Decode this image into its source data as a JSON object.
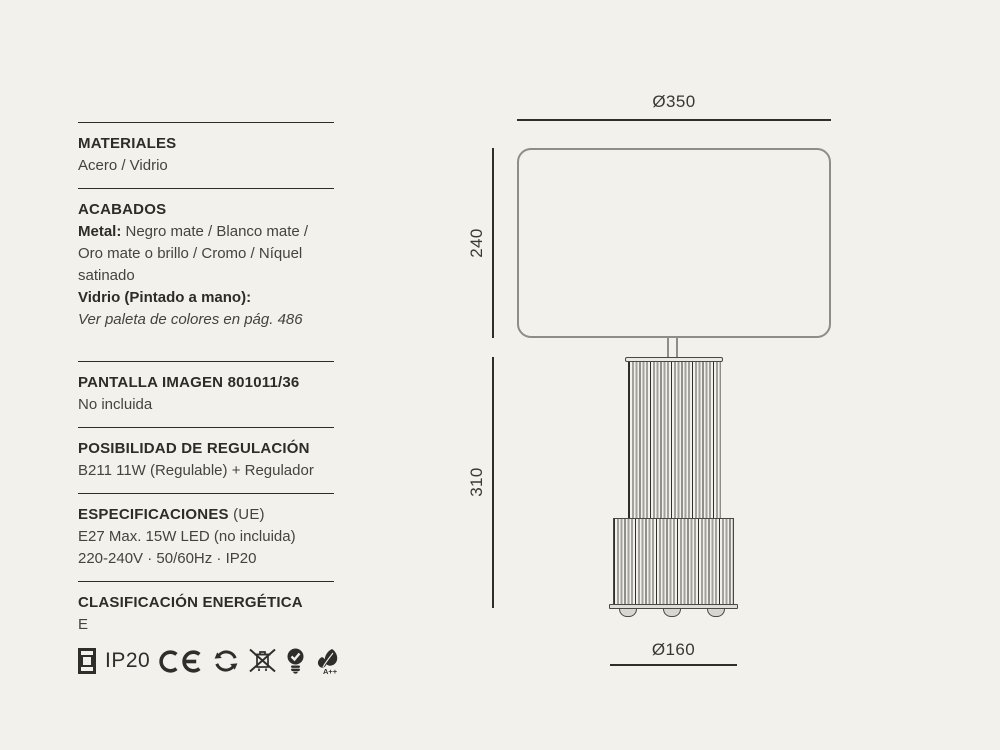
{
  "page": {
    "background_color": "#f2f1ec",
    "heading_color": "#2e2c27",
    "body_color": "#45433d",
    "drawing_line_color": "#8e8d87",
    "dimension_line_color": "#2f2e2a"
  },
  "specs": {
    "materiales": {
      "heading": "MATERIALES",
      "value": "Acero / Vidrio"
    },
    "acabados": {
      "heading": "ACABADOS",
      "metal_label": "Metal:",
      "metal_value": " Negro mate / Blanco mate / Oro mate o brillo / Cromo / Níquel satinado",
      "vidrio_label": "Vidrio (Pintado a mano)",
      "vidrio_colon": ":",
      "vidrio_note": "Ver paleta de colores en pág. 486"
    },
    "pantalla": {
      "heading": "PANTALLA IMAGEN 801011/36",
      "value": "No incluida"
    },
    "regulacion": {
      "heading": "POSIBILIDAD DE REGULACIÓN",
      "value": "B211 11W (Regulable) + Regulador"
    },
    "especificaciones": {
      "heading": "ESPECIFICACIONES",
      "heading_suffix": " (UE)",
      "line1": "E27 Max. 15W LED (no incluida)",
      "line2": "220-240V · 50/60Hz · IP20"
    },
    "clasificacion": {
      "heading": "CLASIFICACIÓN ENERGÉTICA",
      "value": "E"
    }
  },
  "certifications": {
    "ip_rating": "IP20",
    "bulb_energy_class": "A++",
    "icons": [
      "class-ii-double-square-icon",
      "ce-mark-icon",
      "recycle-circle-arrows-icon",
      "weee-crossed-bin-icon",
      "bulb-check-icon",
      "leaf-energy-icon"
    ]
  },
  "drawing": {
    "dim_shade_diameter": "Ø350",
    "dim_shade_height": "240",
    "dim_body_height": "310",
    "dim_base_diameter": "Ø160"
  }
}
